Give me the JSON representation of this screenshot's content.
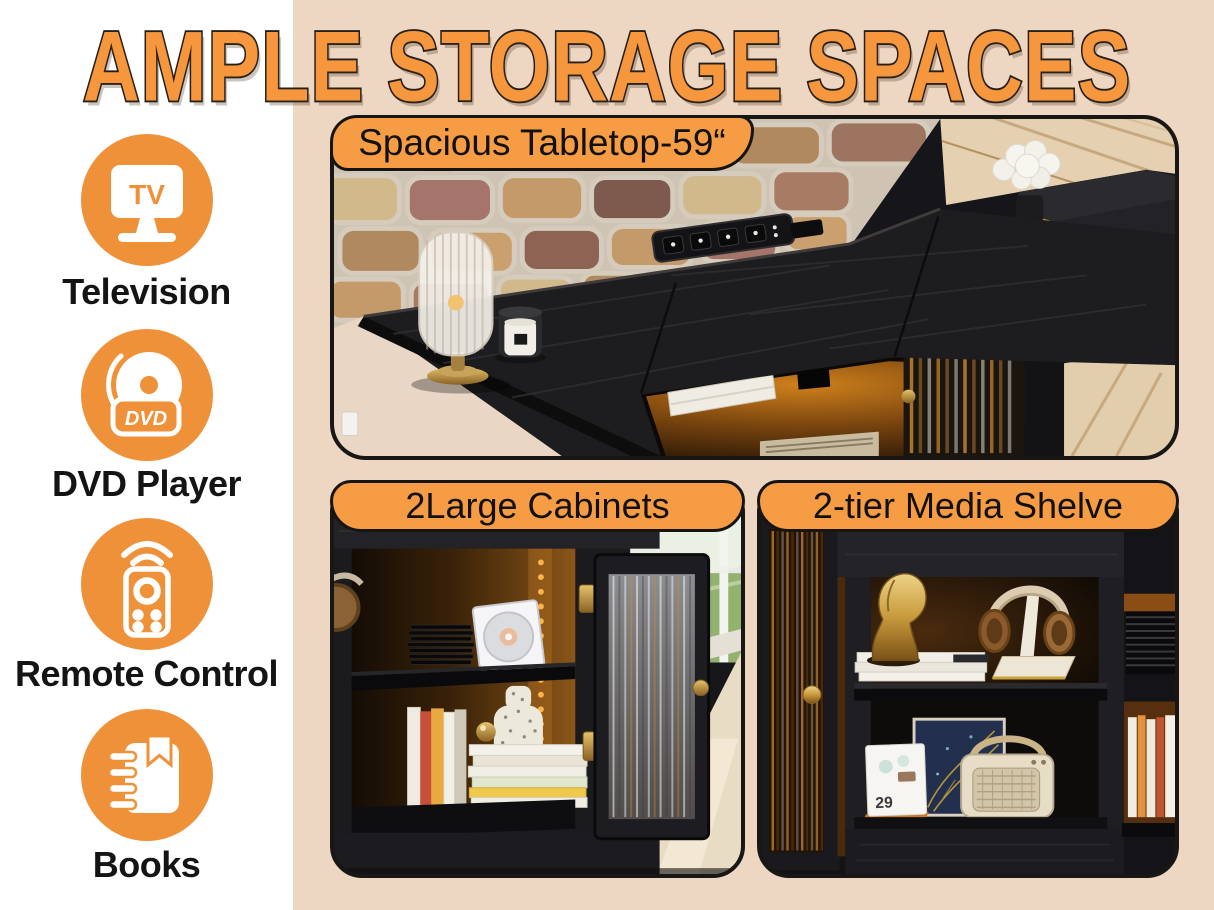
{
  "title": "AMPLE STORAGE SPACES",
  "colors": {
    "background": "#EDD6C2",
    "sidebar_panel": "#FFFFFF",
    "accent_orange": "#EF9139",
    "badge_orange": "#F59C45",
    "title_orange": "#F6973E",
    "outline_black": "#1C1916",
    "label_text": "#141414",
    "furniture_black": "#1D1C1E"
  },
  "sidebar": {
    "items": [
      {
        "label": "Television",
        "icon": "tv-icon",
        "icon_text": "TV"
      },
      {
        "label": "DVD Player",
        "icon": "dvd-player-icon",
        "icon_text": "DVD"
      },
      {
        "label": "Remote Control",
        "icon": "remote-control-icon"
      },
      {
        "label": "Books",
        "icon": "books-icon"
      }
    ]
  },
  "features": {
    "tabletop": {
      "badge": "Spacious Tabletop-59“",
      "alt": "Black TV stand tabletop with ribbed glass lamp, candle, built-in power strip and white flowers against a stone wall"
    },
    "cabinets": {
      "badge": "2Large Cabinets",
      "alt": "Open cabinet with fluted glass door, warm LED backlight, stacked CDs, books and speckled vase"
    },
    "media_shelf": {
      "badge": "2-tier Media Shelve",
      "calendar_day": "29",
      "alt": "Two-tier media shelf with gold statue, headphones on stand, desk calendar, art print and retro radio"
    }
  }
}
